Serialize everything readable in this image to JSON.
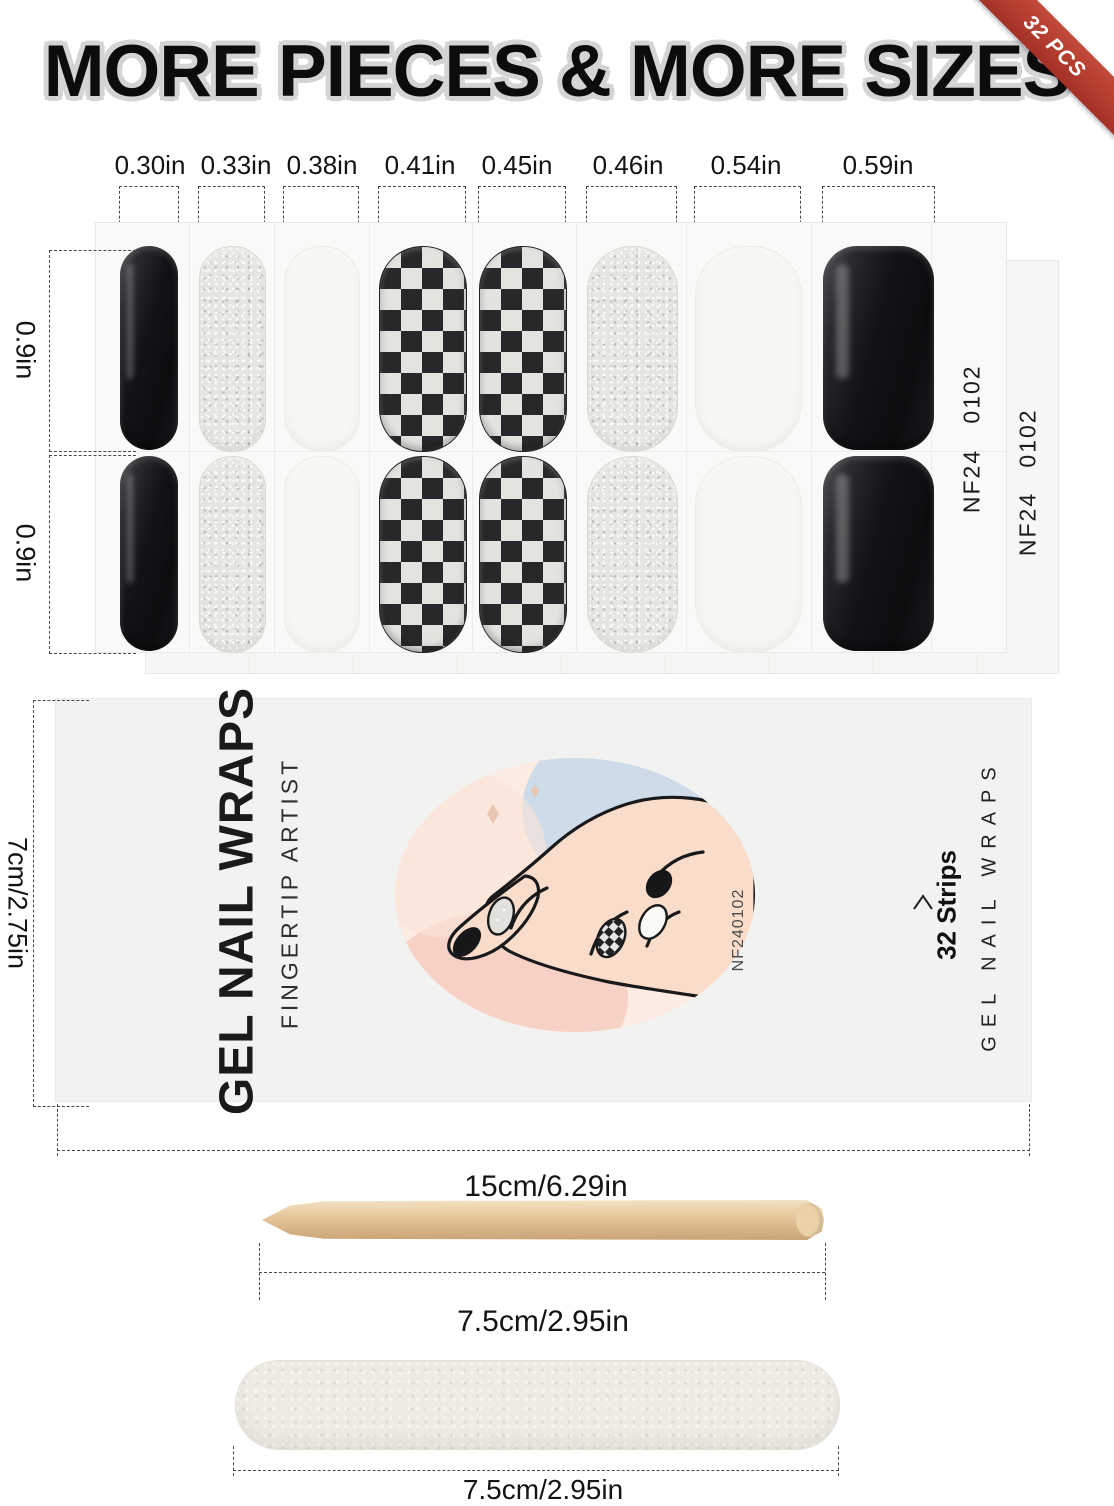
{
  "title": "MORE PIECES & MORE SIZES",
  "badge": {
    "label": "32 PCS"
  },
  "size_columns": {
    "labels": [
      "0.30in",
      "0.33in",
      "0.38in",
      "0.41in",
      "0.45in",
      "0.46in",
      "0.54in",
      "0.59in"
    ]
  },
  "row_labels": {
    "row1": "0.9in",
    "row2": "0.9in"
  },
  "sheet_codes": {
    "color_code": "0102",
    "series_code": "NF24"
  },
  "package": {
    "brand": "GEL NAIL WRAPS",
    "tagline": "FINGERTIP ARTIST",
    "strip_count": "32 Strips",
    "side_brand": "GEL NAIL WRAPS",
    "product_code": "NF240102",
    "width_label": "15cm/6.29in",
    "height_label": "7cm/2.75in"
  },
  "tools": {
    "stick_length_label": "7.5cm/2.95in",
    "file_length_label": "7.5cm/2.95in"
  },
  "colors": {
    "accent_red": "#b03a2e",
    "nail_black": "#141517",
    "glitter_silver": "#e4e3e0",
    "cream_white": "#f7f6f1",
    "wood": "#e0bf94"
  }
}
